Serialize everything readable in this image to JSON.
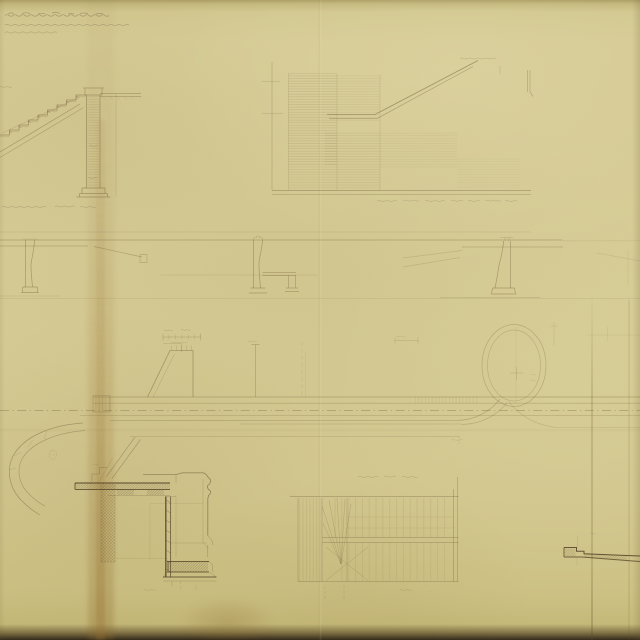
{
  "document": {
    "type": "Aged scanned architectural engineering drawing, sepia ink on yellowed paper; all handwriting too faint to read",
    "title_block": {
      "location": "top-left",
      "lines": 3,
      "legible": false
    },
    "captions": [
      {
        "location": "below-left-stair-section",
        "legible": false
      },
      {
        "location": "below-central-elevation",
        "legible": false
      },
      {
        "location": "above-lower-stair-plan",
        "legible": false
      }
    ],
    "views": [
      {
        "id": "stair-section",
        "label": "stair flight section with masonry pier",
        "position": "top-left"
      },
      {
        "id": "sectional-elevation",
        "label": "long sectional elevation with stair diagonal and brick coursing",
        "position": "top-center"
      },
      {
        "id": "longitudinal-section",
        "label": "longitudinal section with three tapered piers",
        "position": "middle-band"
      },
      {
        "id": "track-plan",
        "label": "plan with dash-dot centerline, ramp, curved spur and turntable circle",
        "position": "center"
      },
      {
        "id": "masonry-detail",
        "label": "hatched masonry wall and footing detail",
        "position": "bottom-left"
      },
      {
        "id": "stair-plan",
        "label": "stair plan with treads and winders",
        "position": "bottom-center"
      },
      {
        "id": "coping-detail",
        "label": "stepped coping section detail",
        "position": "bottom-right"
      }
    ],
    "counts": {
      "stair_steps": 10,
      "section_piers": 3,
      "plan_tread_columns": 18,
      "winder_lines": 6
    }
  },
  "palette": {
    "paper": "#d6cb95",
    "paper_shadow": "#c9bd82",
    "edge_dark": "#32291a",
    "ink": "#6e5a36",
    "ink_dark": "#4a3820",
    "pencil": "#6f6147",
    "stain": "#a08347"
  },
  "scan_artifacts": {
    "vertical_stain_x": 100,
    "fold_x": 320,
    "crease_x": 592,
    "horizontal_fold_y": 430,
    "bottom_edge": "dark band"
  }
}
